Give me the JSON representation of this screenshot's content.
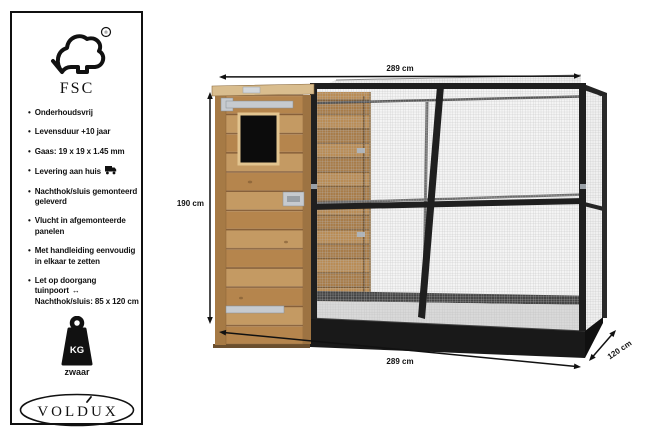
{
  "panel": {
    "fsc": {
      "label": "FSC",
      "reg": "®"
    },
    "features": [
      {
        "text": "Onderhoudsvrij"
      },
      {
        "text": "Levensduur +10 jaar"
      },
      {
        "text": "Gaas: 19 x 19 x 1.45 mm"
      },
      {
        "text": "Levering aan huis",
        "icon": "truck"
      },
      {
        "text": "Nachthok/sluis gemonteerd",
        "text2": "geleverd"
      },
      {
        "text": "Vlucht in afgemonteerde",
        "text2": "panelen"
      },
      {
        "text": "Met handleiding eenvoudig",
        "text2": "in elkaar te zetten"
      },
      {
        "text": "Let op doorgang tuinpoort",
        "icon": "arrow-lr",
        "text2": "Nachthok/sluis: 85 x 120 cm"
      }
    ],
    "weight": {
      "label": "KG",
      "caption": "zwaar"
    },
    "brand": "VOLDUX"
  },
  "diagram": {
    "dimensions": {
      "top": "289 cm",
      "left": "190 cm",
      "bottom": "289 cm",
      "depth": "120 cm"
    }
  },
  "icons": {
    "bullet": "•",
    "arrow_lr": "↔"
  },
  "colors": {
    "frame_black": "#1f1f1f",
    "mesh_bg": "#f3f3f3",
    "mesh_wire": "#bdbdbd",
    "wood": "#c09057",
    "wood_dark": "#a67a45",
    "wood_light": "#d9bd8e",
    "metal": "#c6cacf",
    "base_black": "#191919"
  }
}
